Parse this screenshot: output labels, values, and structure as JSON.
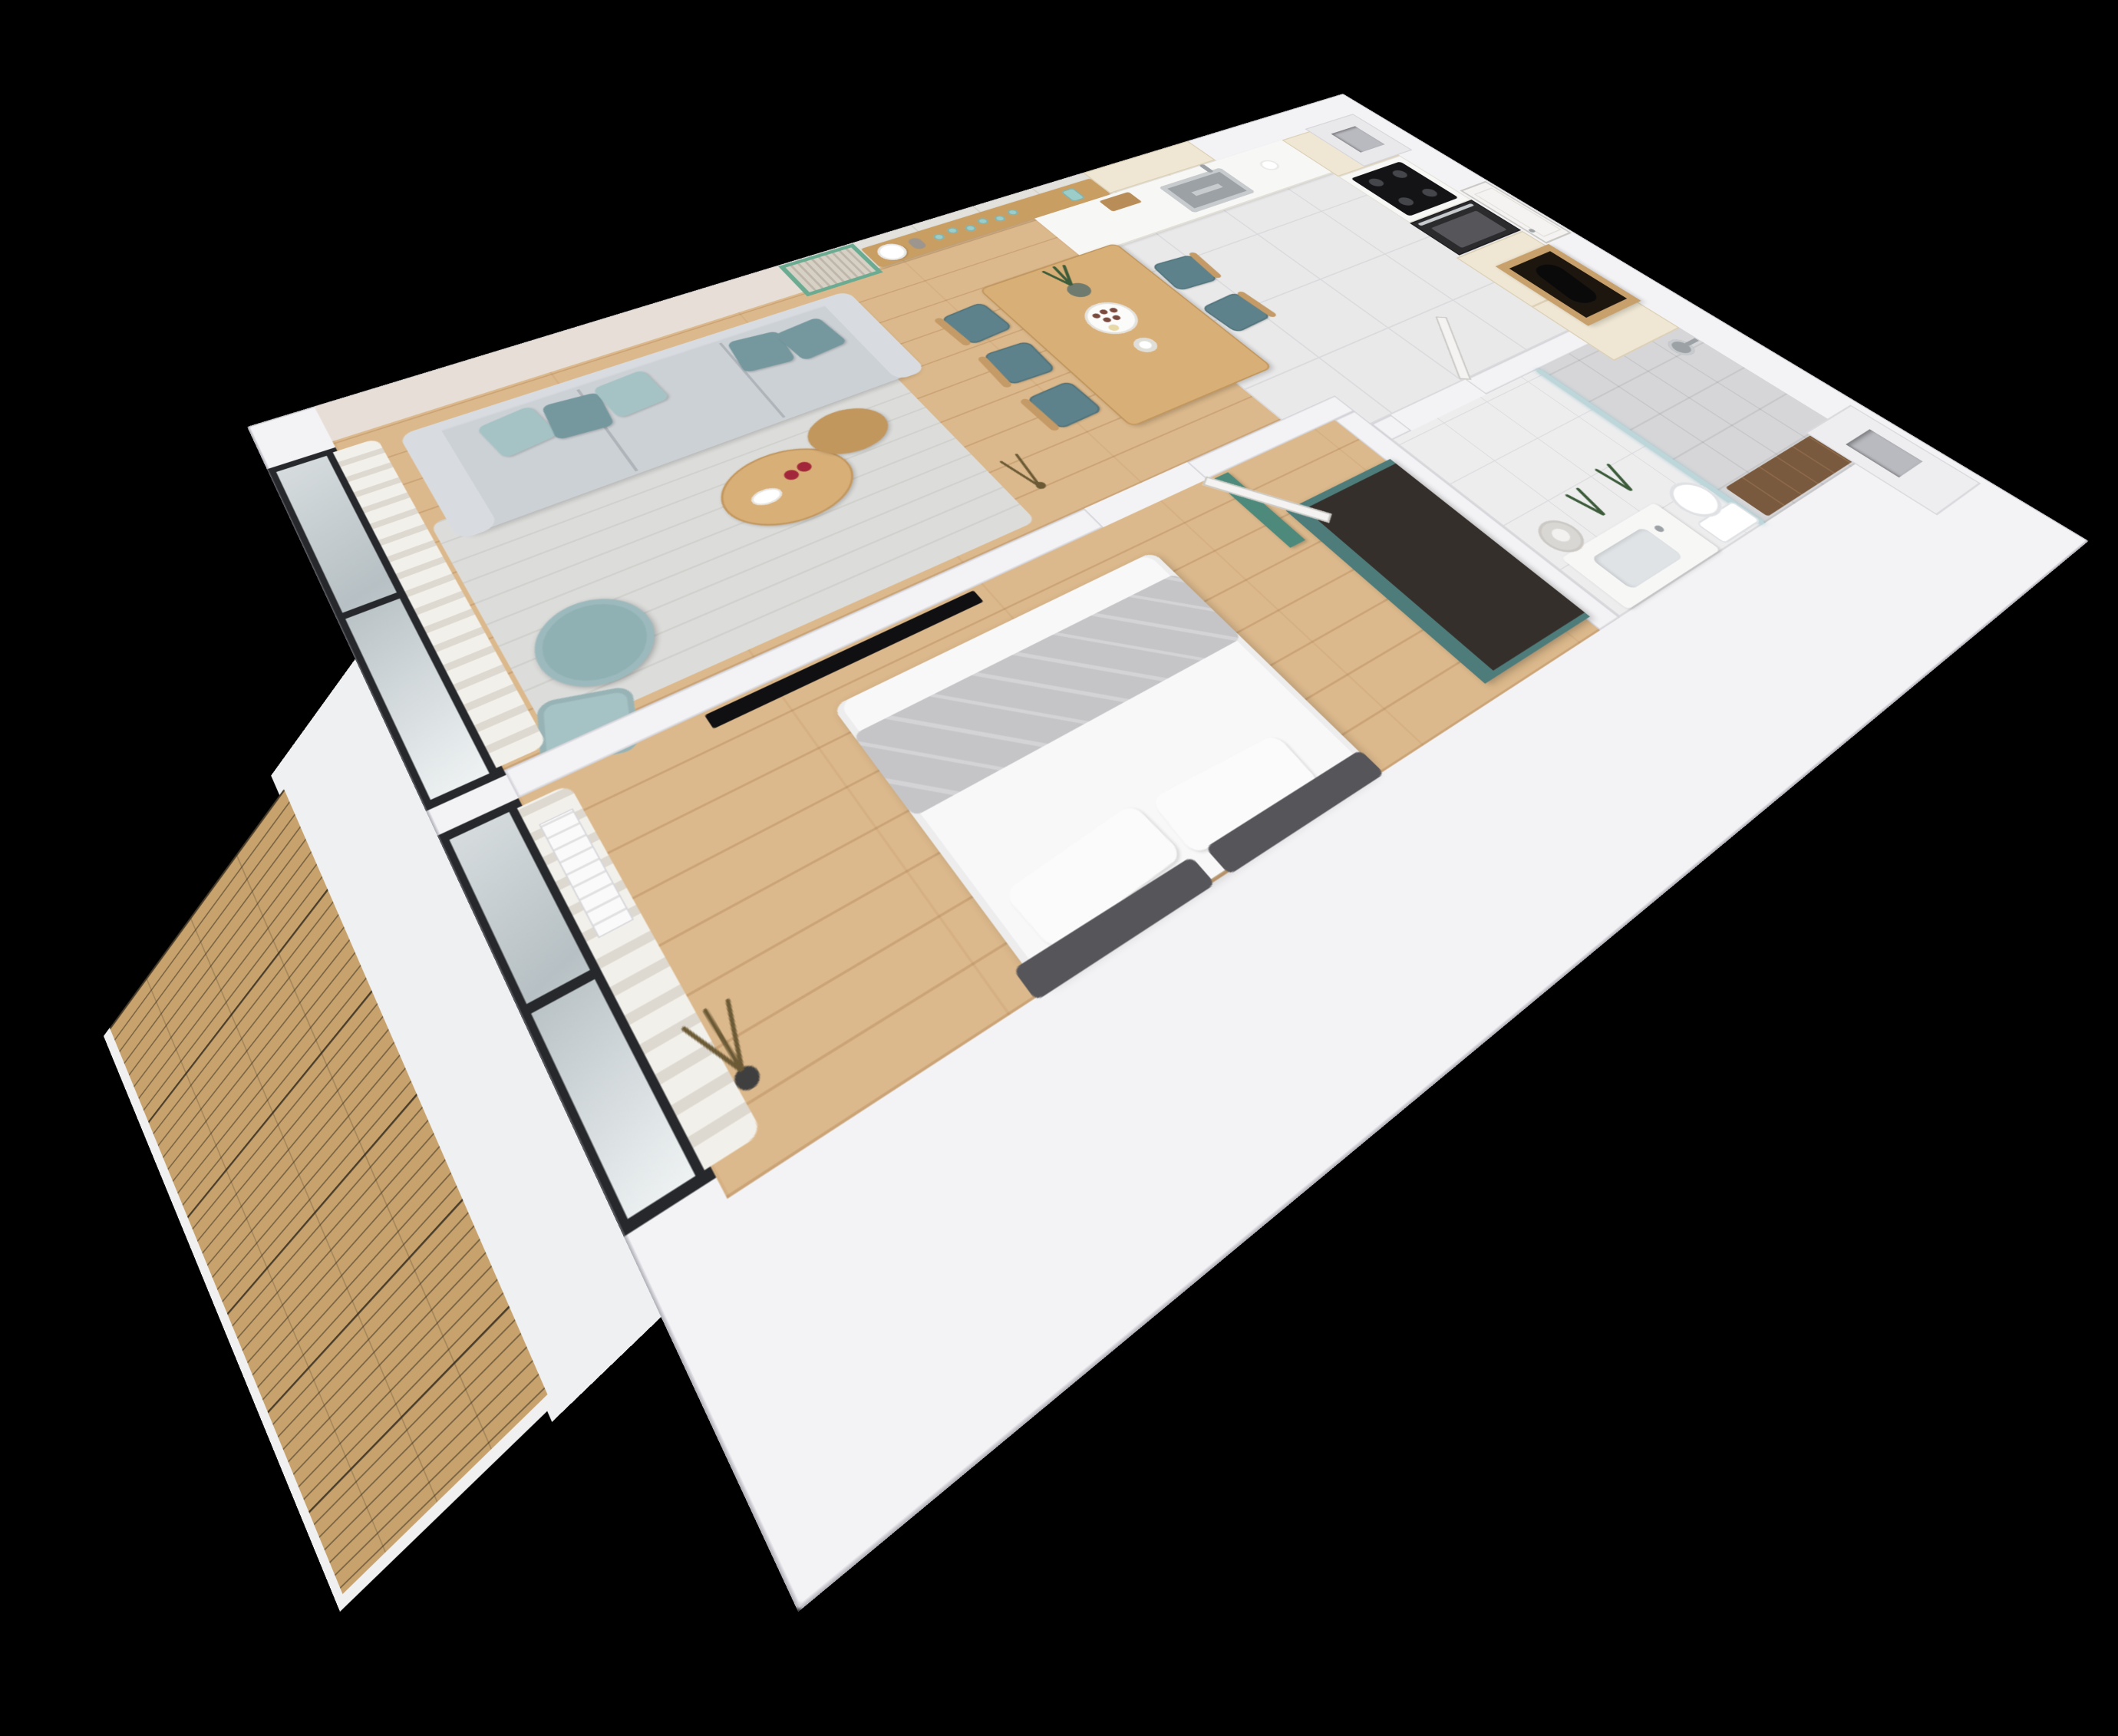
{
  "scene": {
    "type": "3d-apartment-floorplan-render",
    "background_label": "black"
  },
  "colors": {
    "background": "#000000",
    "wallWhite": "#f3f3f5",
    "wallEdge": "#d2d2d8",
    "wallFace": "#eef0f2",
    "wallPink": "#e7dfd7",
    "backsplash": "#e3e1dc",
    "panelLine": "#d2d0c9",
    "woodFloor": "#dcb98c",
    "tileFloor": "#e9e9ea",
    "tileLine": "#dadadd",
    "bathFloor": "#ededee",
    "deckWood": "#c7a26c",
    "deckTrim": "#f0f0f1",
    "glassFrame": "#26282c",
    "glassA": "#d6dcde",
    "glassB": "#b7c0c4",
    "curtain": "#f2f0ea",
    "curtainFold": "#ddd9d0",
    "radiator": "#fafafa",
    "greenFrame": "#6aab91",
    "slatFill": "#d6d0c5",
    "slatLine": "#bdb6a9",
    "shelfWood": "#c99e63",
    "cream": "#efe7d3",
    "creamLine": "#dcd0b6",
    "counterTop": "#f7f7f5",
    "steel": "#c7cbce",
    "steelDark": "#9ba1a5",
    "cooktop": "#141416",
    "burner": "#45464b",
    "ovenFace": "#2b2b2e",
    "ovenWindow": "#55555a",
    "sofaBase": "#ccd1d5",
    "sofaBack": "#d8dce0",
    "sofaSeam": "#aeb4b9",
    "pillowDark": "#74989e",
    "pillowLight": "#a5c3c5",
    "rug": "#dcdcda",
    "rugLine": "#d0d0cd",
    "tableWood": "#d9af78",
    "tableEdge": "#c2975e",
    "chairSeat": "#5d828b",
    "chairWood": "#c49a66",
    "pouf": "#8fb1b4",
    "tvBlack": "#101013",
    "duvet": "#f8f8f9",
    "blanket": "#c5c5c8",
    "pillowWhite": "#fbfbfc",
    "headboard": "#55555a",
    "dresserTeal": "#4e7c7a",
    "dresserTop": "#352f2b",
    "tealDoor": "#4e8a7b",
    "doorWhite": "#f4f3f1",
    "doorEdge": "#c9c8c4",
    "closetWood": "#c8a06b",
    "closetDark": "#1d160f",
    "coat": "#0a0a0b",
    "showerTile": "#d6d6d8",
    "showerGlass": "#bcd6da",
    "vanity": "#f7f7f6",
    "basin": "#dfe3e6",
    "toilet": "#ffffff",
    "toiletEdge": "#dfe1e4",
    "walnut": "#7a5a3e",
    "walnutLine": "#8d6a4a",
    "plantGreen": "#3c5c3a",
    "plantDried": "#6b5a35",
    "apple": "#a3273a",
    "platter": "#fbfbfa",
    "platterEdge": "#e4e2dd",
    "cookie": "#7b4a3e",
    "ductHole": "#b9babf",
    "glassTeal": "#9ccdc9"
  }
}
